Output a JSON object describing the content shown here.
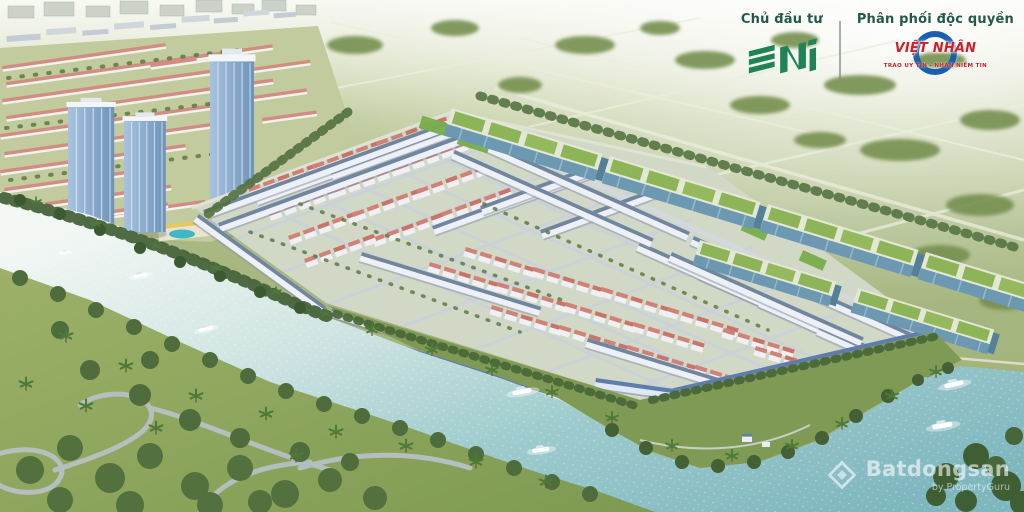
{
  "branding": {
    "investor_label": "Chủ đầu tư",
    "investor_name": "SNI",
    "distributor_label": "Phân phối độc quyền",
    "distributor_name": "VIỆT NHÂN",
    "distributor_tagline": "TRAO UY TÍN - NHẬN NIỀM TIN",
    "colors": {
      "label_green": "#24584a",
      "sni_green": "#1f8355",
      "viet_nhan_red": "#d21f26",
      "viet_nhan_blue": "#1a5fae"
    }
  },
  "watermark": {
    "name": "Batdongsan",
    "byline": "by PropertyGuru",
    "color": "#ffffff"
  },
  "scene": {
    "description": "Aerial 3D masterplan render of a riverside township: perimeter shophouse rows with slate-blue roofs, red-roof villa clusters, three blue glass towers, green-roof warehouses along the rear boundary, winding river with white yachts, riverside park with palms and walking paths, hazy green fields at the horizon",
    "palette": {
      "field_green": "#a9b883",
      "tree_green": "#49663a",
      "park_green": "#8aa35e",
      "river_teal": "#9fc7c9",
      "villa_roof": "#d08276",
      "townhouse_roof": "#6d84ac",
      "warehouse_roof": "#8db456",
      "tower_glass": "#8aabce"
    },
    "boats_count": 7
  }
}
